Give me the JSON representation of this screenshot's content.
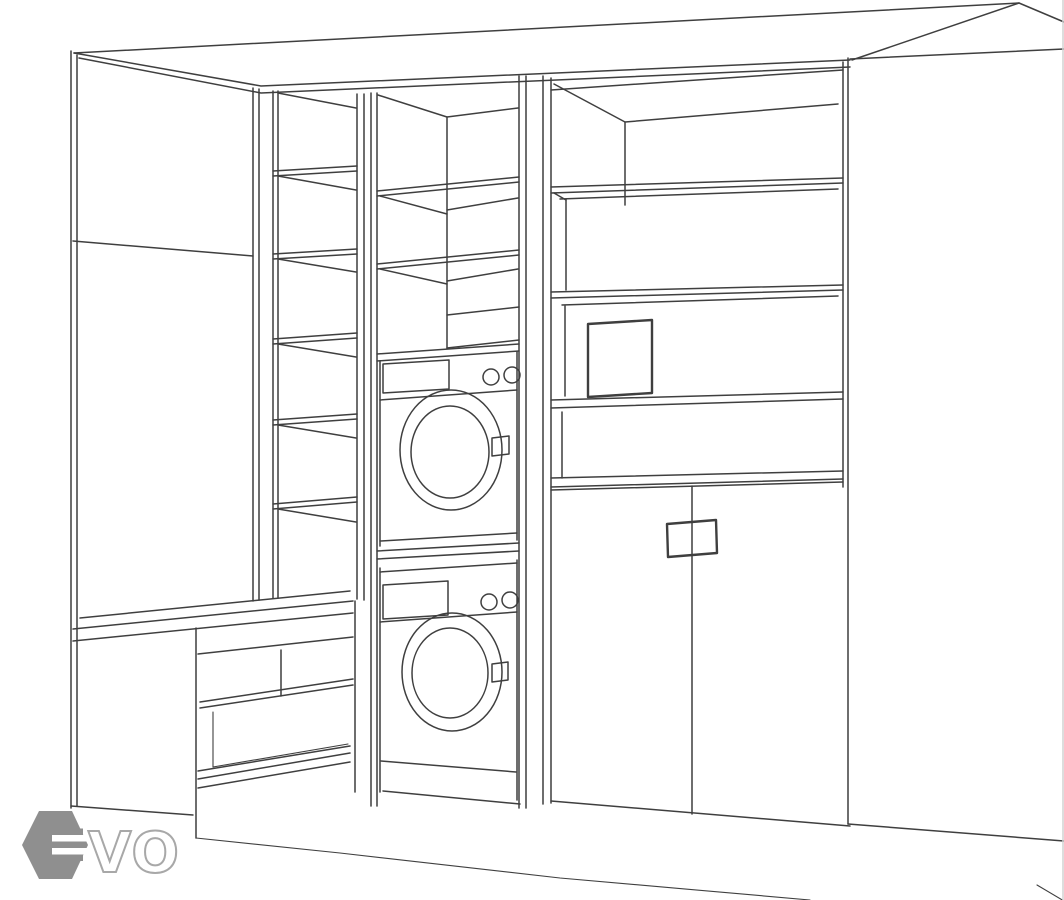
{
  "canvas": {
    "width": 1064,
    "height": 900
  },
  "colors": {
    "bg": "#ffffff",
    "ink": "#3f3f3f",
    "hex": "#8f8f8f",
    "outline": "#a8a8a8",
    "border": "#d2d2d2"
  },
  "watermark": {
    "visible_text": "VO",
    "logo_mark": "hexagon-e-icon"
  }
}
